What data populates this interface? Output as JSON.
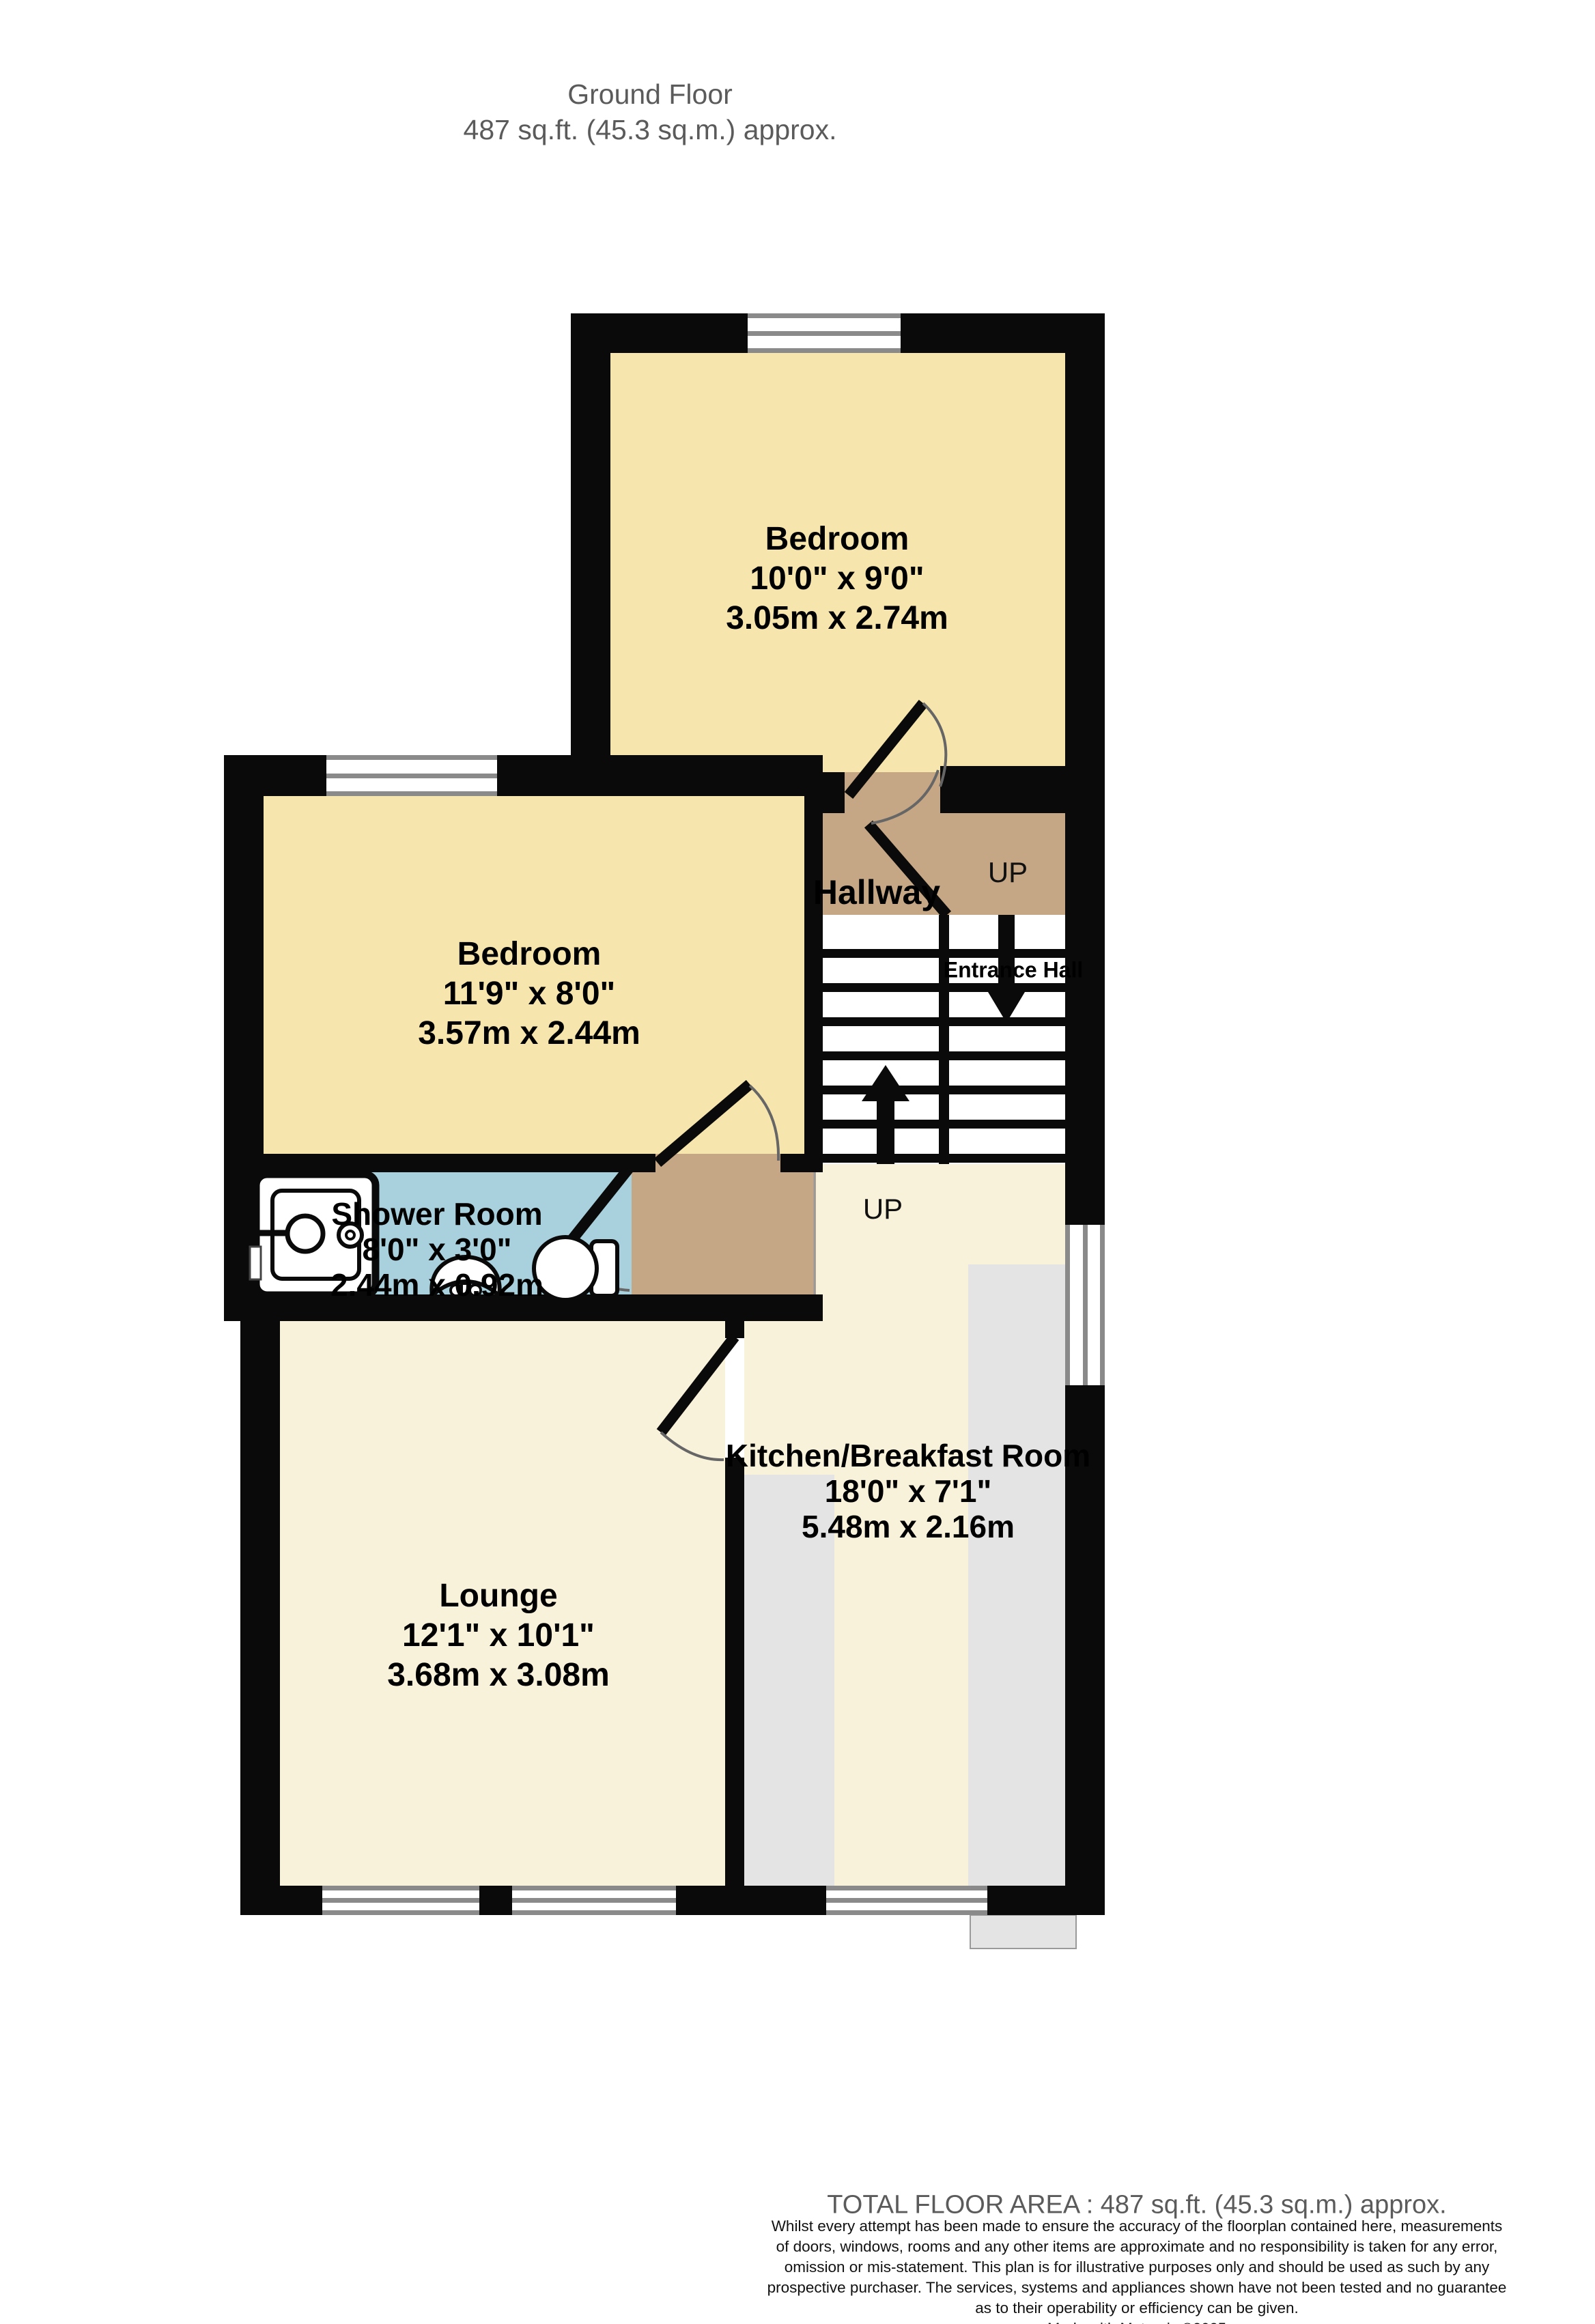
{
  "page": {
    "title": "Ground Floor",
    "subtitle": "487 sq.ft. (45.3 sq.m.) approx."
  },
  "rooms": {
    "bedroom_top": {
      "name": "Bedroom",
      "size_imperial": "10'0\"  x 9'0\"",
      "size_metric": "3.05m  x 2.74m"
    },
    "bedroom_left": {
      "name": "Bedroom",
      "size_imperial": "11'9\"  x 8'0\"",
      "size_metric": "3.57m  x 2.44m"
    },
    "shower_room": {
      "name": "Shower Room",
      "size_imperial": "8'0\"  x 3'0\"",
      "size_metric": "2.44m  x 0.92m"
    },
    "kitchen": {
      "name": "Kitchen/Breakfast Room",
      "size_imperial": "18'0\"  x 7'1\"",
      "size_metric": "5.48m  x 2.16m"
    },
    "lounge": {
      "name": "Lounge",
      "size_imperial": "12'1\"  x 10'1\"",
      "size_metric": "3.68m  x 3.08m"
    },
    "hallway": {
      "name": "Hallway"
    },
    "entrance_hall": {
      "name": "Entrance Hall"
    }
  },
  "stairs": {
    "up_label_hallway": "UP",
    "up_label_kitchen": "UP"
  },
  "footer": {
    "total_area": "TOTAL FLOOR AREA : 487 sq.ft. (45.3 sq.m.) approx.",
    "disclaimer_lines": [
      "Whilst every attempt has been made to ensure the accuracy of the floorplan contained here, measurements",
      "of doors, windows, rooms and any other items are approximate and no responsibility is taken for any error,",
      "omission or mis-statement. This plan is for illustrative purposes only and should be used as such by any",
      "prospective purchaser. The services, systems and appliances shown have not been tested and no guarantee",
      "as to their operability or efficiency can be given."
    ],
    "credit": "Made with Metropix ©2025"
  },
  "colors": {
    "room_yellow": "#F6E5AC",
    "room_cream": "#F8F2DB",
    "hallway_tan": "#C5A785",
    "shower_blue": "#A9D1DD",
    "counter_grey": "#E4E4E4",
    "wall_black": "#0A0A0A",
    "window_grey": "#8A8A8A",
    "title_grey": "#5B5B5B"
  }
}
